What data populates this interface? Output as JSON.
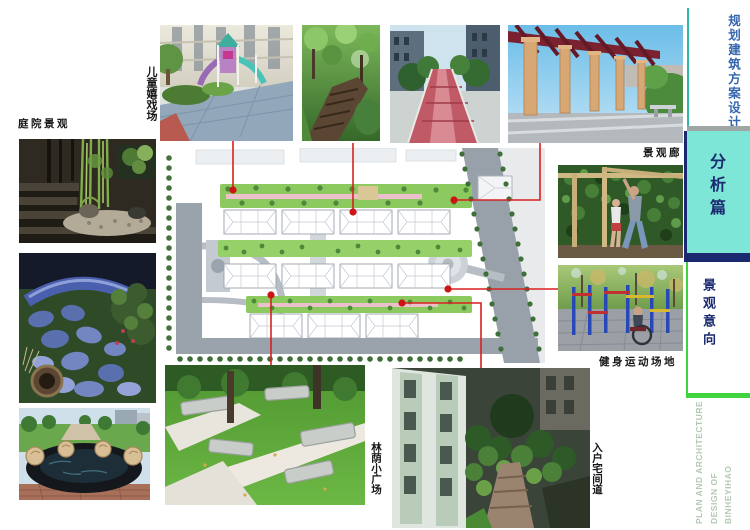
{
  "title_block": {
    "project_type": "规划建筑方案设计",
    "project_name": "滨河壹号",
    "project_region": "奉新",
    "section_label": "分析篇",
    "subsection_label": "景观意向",
    "footer_lines": [
      "PLAN AND ARCHITECTURE",
      "DESIGN OF",
      "BINHEYIHAO"
    ]
  },
  "captions": {
    "courtyard": "庭院景观",
    "children_play": "儿童嬉戏场",
    "gallery": "景观廊",
    "fitness": "健身运动场地",
    "shaded_plaza": "林荫小广场",
    "entry_path": "入户宅间道"
  },
  "colors": {
    "accent_cyan": "#7de6d6",
    "accent_navy": "#1b2a70",
    "accent_green": "#3fd43f",
    "accent_blue_text": "#3465ae",
    "connector_red": "#d92020",
    "footer_text": "#b2c8b2"
  }
}
